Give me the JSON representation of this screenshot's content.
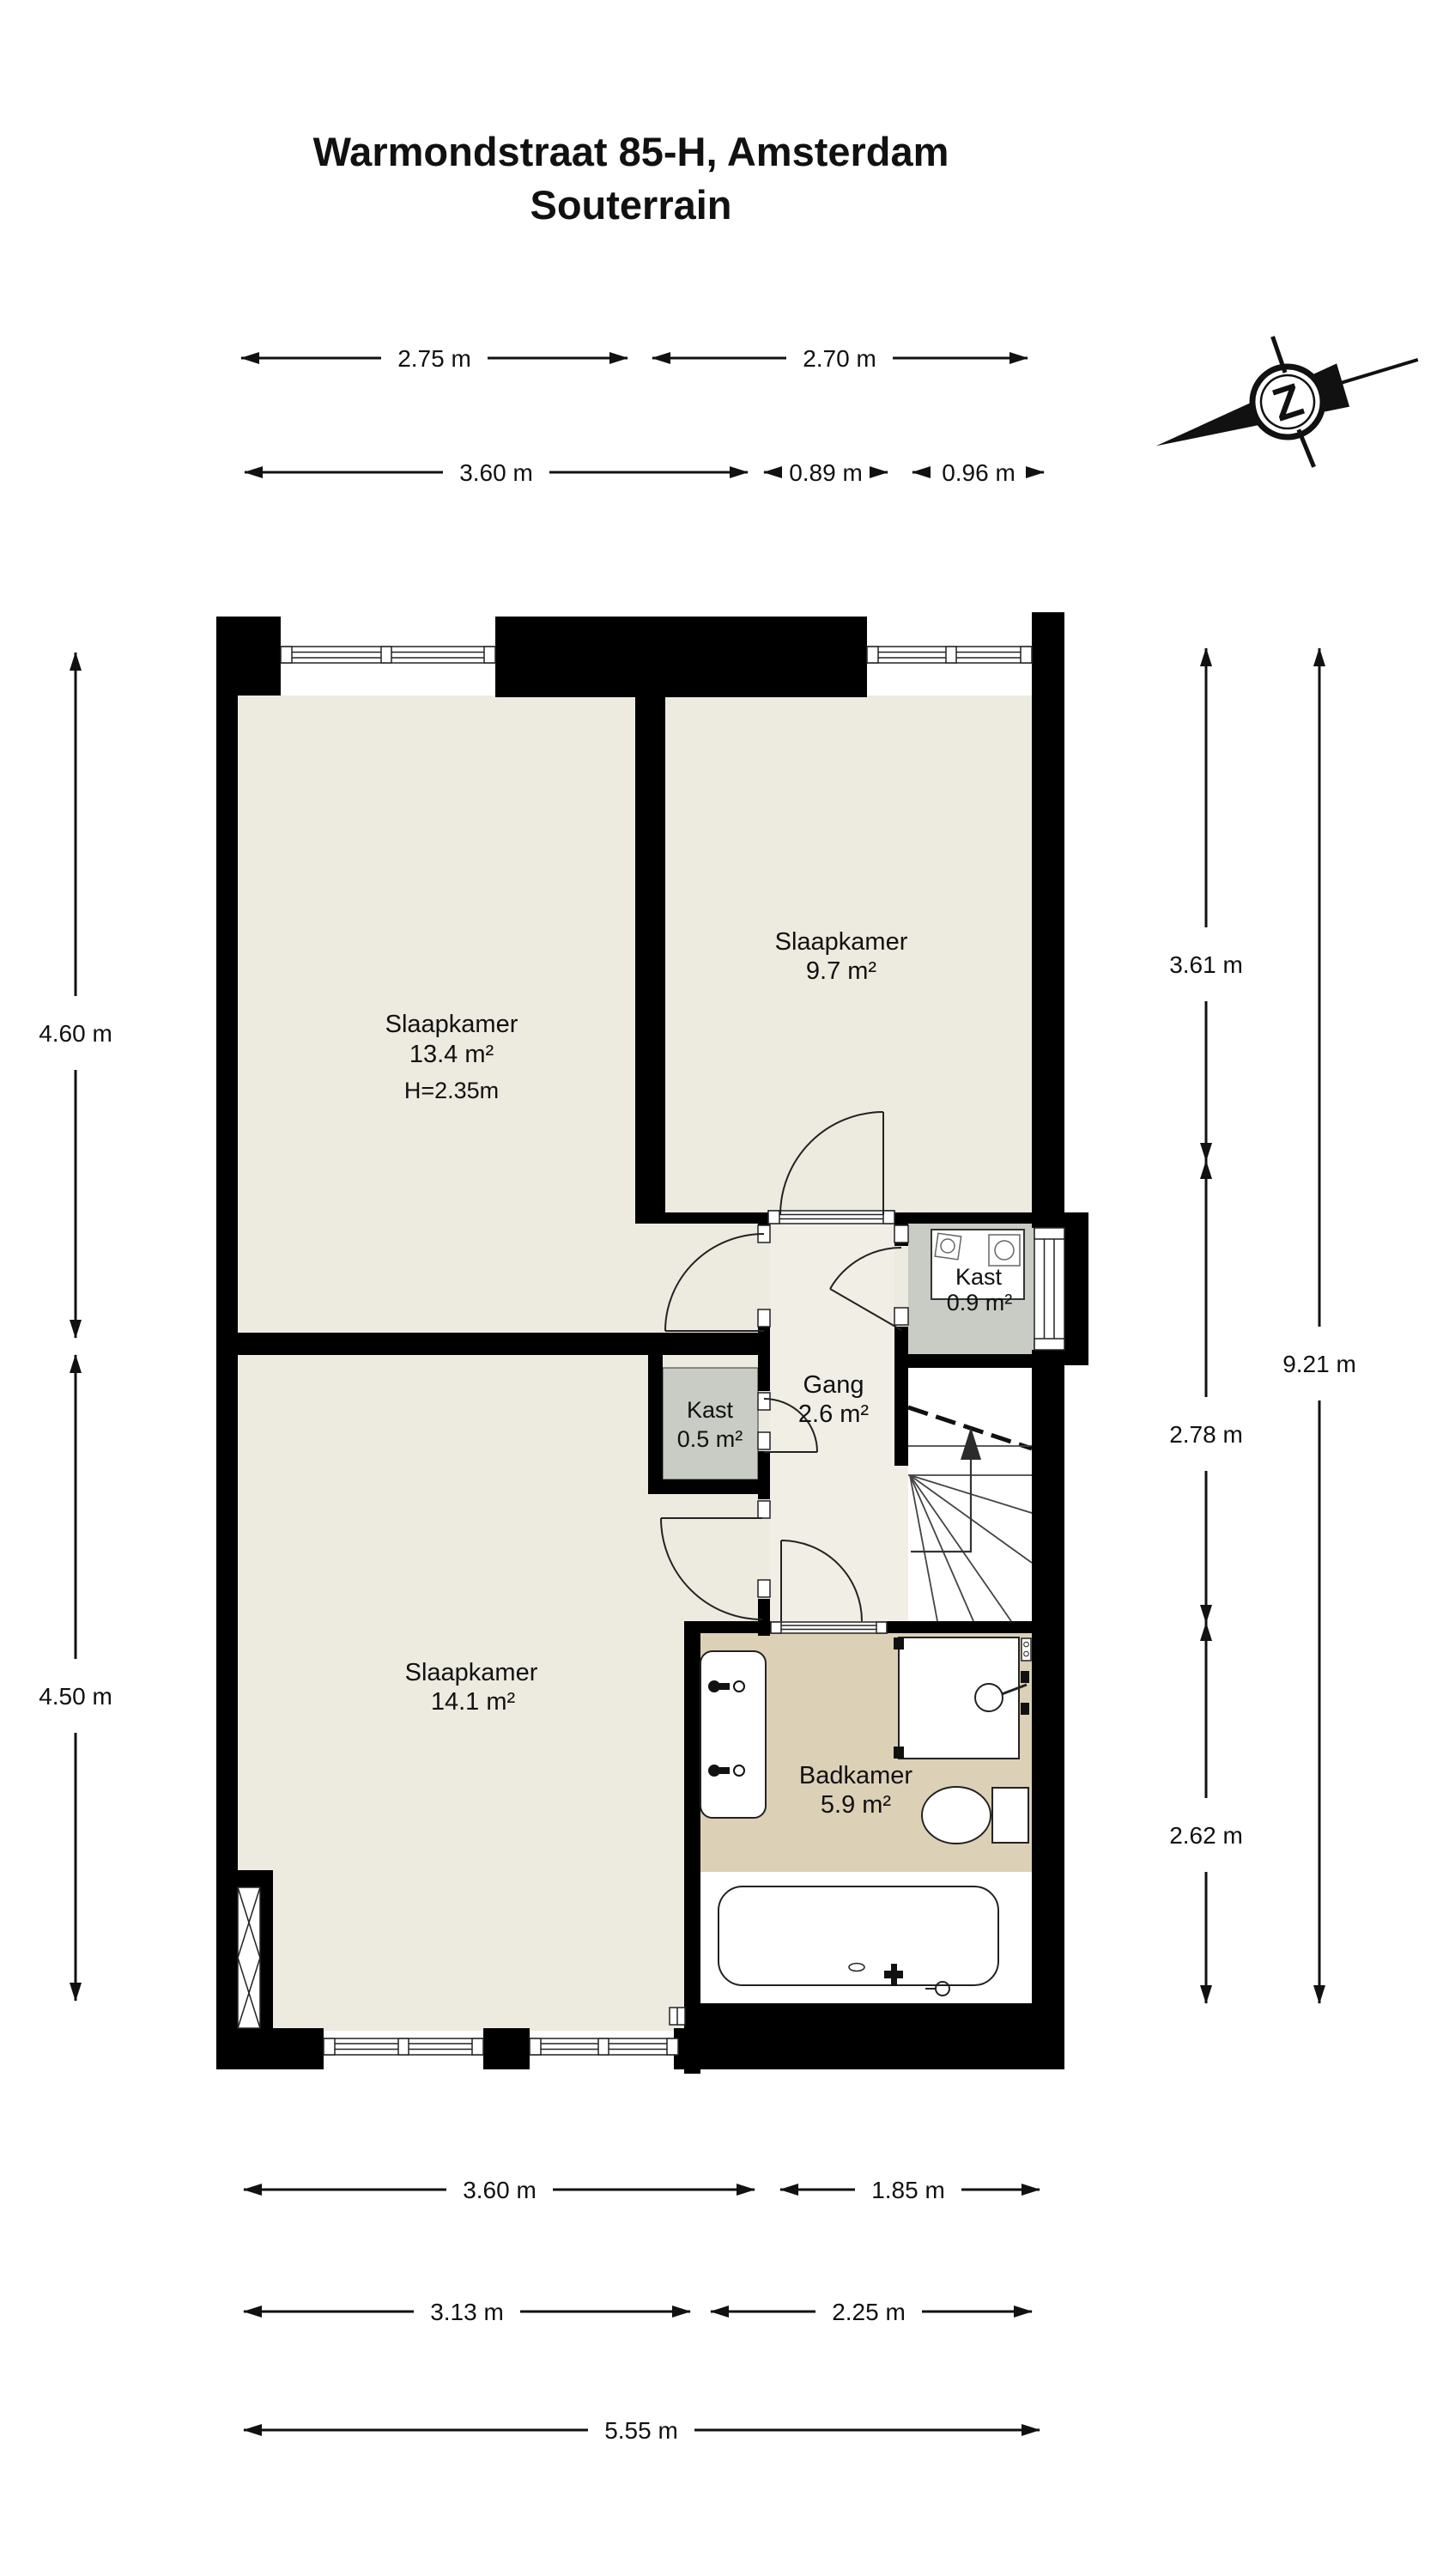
{
  "title": {
    "line1": "Warmondstraat 85-H, Amsterdam",
    "line2": "Souterrain"
  },
  "compass": {
    "letter": "Z"
  },
  "rooms": {
    "slaapkamer1": {
      "name": "Slaapkamer",
      "area": "13.4 m²",
      "height_note": "H=2.35m"
    },
    "slaapkamer2": {
      "name": "Slaapkamer",
      "area": "9.7 m²"
    },
    "slaapkamer3": {
      "name": "Slaapkamer",
      "area": "14.1 m²"
    },
    "badkamer": {
      "name": "Badkamer",
      "area": "5.9 m²"
    },
    "gang": {
      "name": "Gang",
      "area": "2.6 m²"
    },
    "kast_klein": {
      "name": "Kast",
      "area": "0.5 m²"
    },
    "kast_groot": {
      "name": "Kast",
      "area": "0.9 m²"
    }
  },
  "dimensions": {
    "top_row1": [
      "2.75 m",
      "2.70 m"
    ],
    "top_row2": [
      "3.60 m",
      "0.89 m",
      "0.96 m"
    ],
    "left": [
      "4.60 m",
      "4.50 m"
    ],
    "right_inner": [
      "3.61 m",
      "2.78 m",
      "2.62 m"
    ],
    "right_outer": "9.21 m",
    "bottom_row1": [
      "3.60 m",
      "1.85 m"
    ],
    "bottom_row2": [
      "3.13 m",
      "2.25 m"
    ],
    "bottom_row3": "5.55 m"
  },
  "colors": {
    "wall": "#000000",
    "room_floor": "#EDEAE0",
    "gang_floor": "#F1EEE6",
    "closet_floor": "#C9CCC4",
    "bathroom_floor": "#DCD0B7",
    "line": "#111111"
  }
}
